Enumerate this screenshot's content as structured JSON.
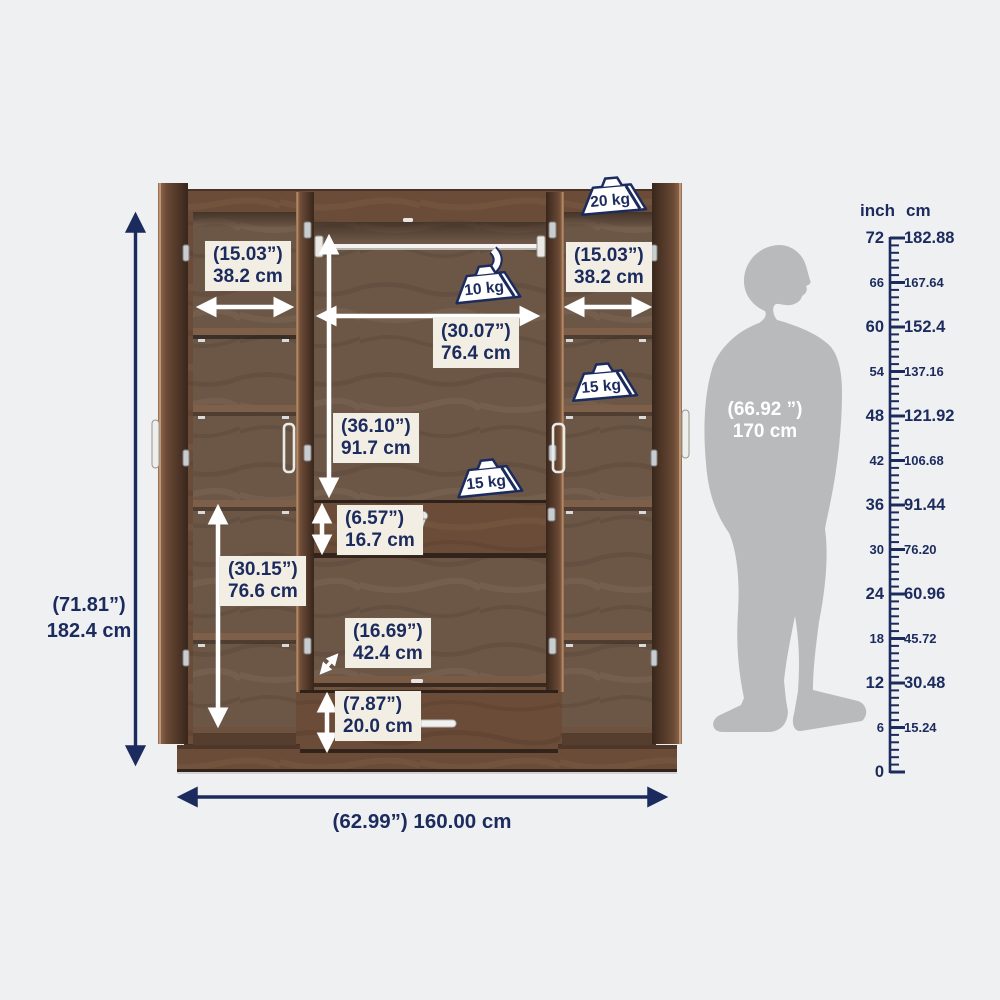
{
  "title": "Four-door wardrobe dimension diagram",
  "dims": {
    "left_shelf": {
      "inch": "(15.03”)",
      "cm": "38.2 cm"
    },
    "right_shelf": {
      "inch": "(15.03”)",
      "cm": "38.2 cm"
    },
    "middle_width": {
      "inch": "(30.07”)",
      "cm": "76.4 cm"
    },
    "middle_height": {
      "inch": "(36.10”)",
      "cm": "91.7 cm"
    },
    "middle_drawer": {
      "inch": "(6.57”)",
      "cm": "16.7 cm"
    },
    "left_lower": {
      "inch": "(30.15”)",
      "cm": "76.6 cm"
    },
    "depth": {
      "inch": "(16.69”)",
      "cm": "42.4 cm"
    },
    "bottom_drawer": {
      "inch": "(7.87”)",
      "cm": "20.0 cm"
    },
    "total_height": {
      "inch": "(71.81”)",
      "cm": "182.4 cm"
    },
    "total_width": {
      "text": "(62.99”) 160.00 cm"
    },
    "person": {
      "inch": "(66.92 ”)",
      "cm": "170 cm"
    }
  },
  "weights": {
    "top_right": "20 kg",
    "hanging_rod": "10 kg",
    "right_shelf": "15 kg",
    "middle_shelf": "15 kg"
  },
  "ruler": {
    "unit_left": "inch",
    "unit_right": "cm",
    "rows": [
      {
        "inch": "72",
        "cm": "182.88"
      },
      {
        "inch": "66",
        "cm": "167.64"
      },
      {
        "inch": "60",
        "cm": "152.4"
      },
      {
        "inch": "54",
        "cm": "137.16"
      },
      {
        "inch": "48",
        "cm": "121.92"
      },
      {
        "inch": "42",
        "cm": "106.68"
      },
      {
        "inch": "36",
        "cm": "91.44"
      },
      {
        "inch": "30",
        "cm": "76.20"
      },
      {
        "inch": "24",
        "cm": "60.96"
      },
      {
        "inch": "18",
        "cm": "45.72"
      },
      {
        "inch": "12",
        "cm": "30.48"
      },
      {
        "inch": "6",
        "cm": "15.24"
      },
      {
        "inch": "0",
        "cm": ""
      }
    ]
  },
  "colors": {
    "accent_navy": "#1c2b5e",
    "label_background": "#f2eee3",
    "silhouette_gray": "#b9babc",
    "background": "#eff0f1"
  }
}
